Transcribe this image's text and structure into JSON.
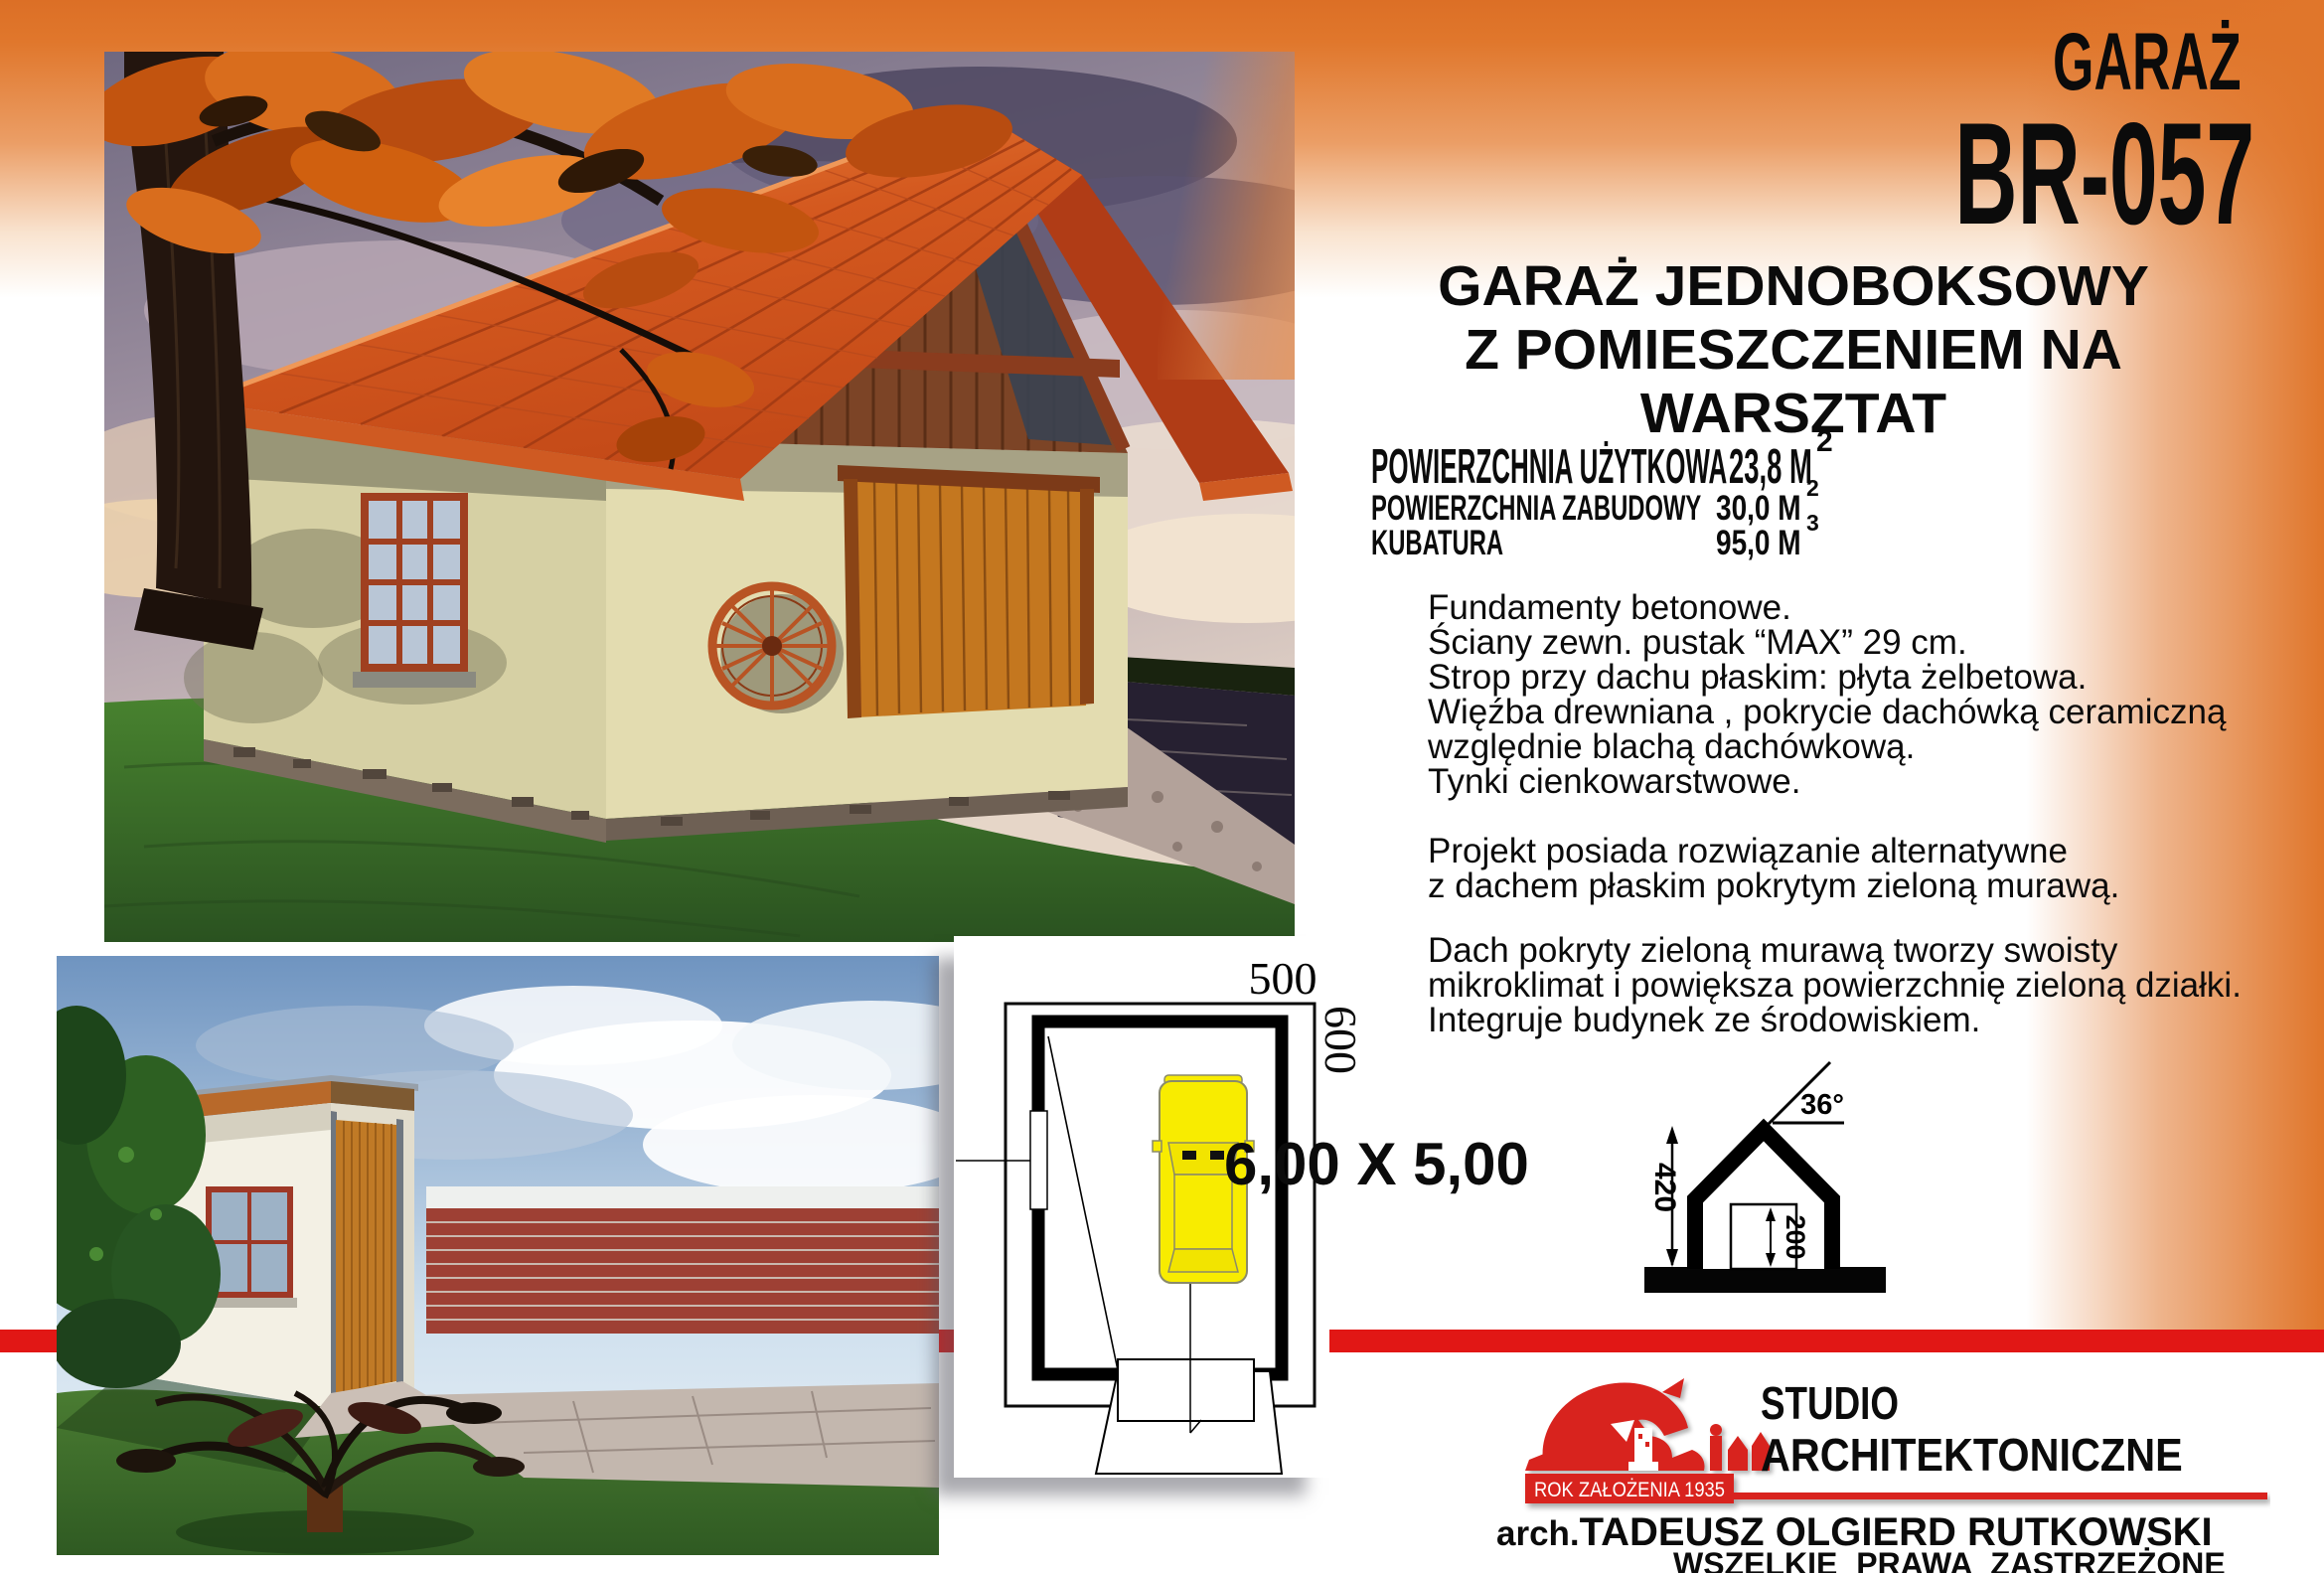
{
  "header": {
    "category_label": "GARAŻ",
    "project_code": "BR-057",
    "subtitle_lines": [
      "GARAŻ JEDNOBOKSOWY",
      "Z POMIESZCZENIEM NA",
      "WARSZTAT"
    ]
  },
  "specs": {
    "rows": [
      {
        "label": "POWIERZCHNIA UŻYTKOWA",
        "value": "23,8 M",
        "sup": "2"
      },
      {
        "label": "POWIERZCHNIA ZABUDOWY",
        "value": "30,0 M",
        "sup": "2"
      },
      {
        "label": "KUBATURA",
        "value": "95,0 M",
        "sup": "3"
      }
    ]
  },
  "description": {
    "para1": [
      "Fundamenty betonowe.",
      "Ściany zewn. pustak “MAX” 29 cm.",
      "Strop przy dachu płaskim: płyta żelbetowa.",
      "Więźba drewniana , pokrycie dachówką ceramiczną",
      "względnie blachą dachówkową.",
      "Tynki cienkowarstwowe."
    ],
    "para2": [
      "Projekt posiada rozwiązanie alternatywne",
      "z dachem płaskim pokrytym zieloną murawą."
    ],
    "para3": [
      "Dach pokryty zieloną murawą tworzy swoisty",
      "mikroklimat i powiększa powierzchnię zieloną działki.",
      "Integruje budynek ze środowiskiem."
    ]
  },
  "plan": {
    "width_label": "500",
    "depth_label": "600",
    "dimensions_text": "6,00 X 5,00"
  },
  "section": {
    "roof_angle": "36°",
    "ridge_height": "420",
    "door_height": "200"
  },
  "footer": {
    "founded_text": "ROK ZAŁOŻENIA 1935",
    "studio_line1": "STUDIO",
    "studio_line2": "ARCHITEKTONICZNE",
    "architect_prefix": "arch.",
    "architect_name": "TADEUSZ OLGIERD RUTKOWSKI",
    "rights_text": "WSZELKIE PRAWA ZASTRZEŻONE"
  },
  "colors": {
    "banner_orange": "#e0762b",
    "bar_red": "#e11715",
    "logo_red": "#d8231e",
    "roof_red": "#d4591f",
    "car_yellow": "#f8ec00"
  }
}
